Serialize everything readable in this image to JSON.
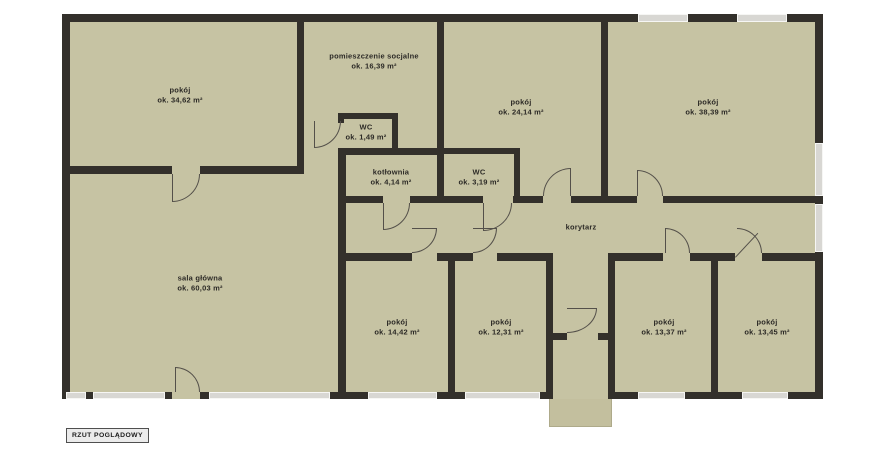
{
  "plan": {
    "rooms": [
      {
        "name": "pokój",
        "area": "ok. 34,62 m²"
      },
      {
        "name": "pomieszczenie socjalne",
        "area": "ok. 16,39 m²"
      },
      {
        "name": "WC",
        "area": "ok. 1,49 m²"
      },
      {
        "name": "kotłownia",
        "area": "ok. 4,14 m²"
      },
      {
        "name": "WC",
        "area": "ok. 3,19 m²"
      },
      {
        "name": "pokój",
        "area": "ok. 24,14 m²"
      },
      {
        "name": "pokój",
        "area": "ok. 38,39 m²"
      },
      {
        "name": "sala główna",
        "area": "ok. 60,03 m²"
      },
      {
        "name": "pokój",
        "area": "ok. 14,42 m²"
      },
      {
        "name": "pokój",
        "area": "ok. 12,31 m²"
      },
      {
        "name": "pokój",
        "area": "ok. 13,37 m²"
      },
      {
        "name": "pokój",
        "area": "ok. 13,45 m²"
      }
    ],
    "corridor_label": "korytarz",
    "badge": "RZUT POGLĄDOWY",
    "colors": {
      "floor": "#c6c3a3",
      "wall": "#33302b",
      "window": "#d8d7d3",
      "porch": "#c3bf9e"
    }
  }
}
